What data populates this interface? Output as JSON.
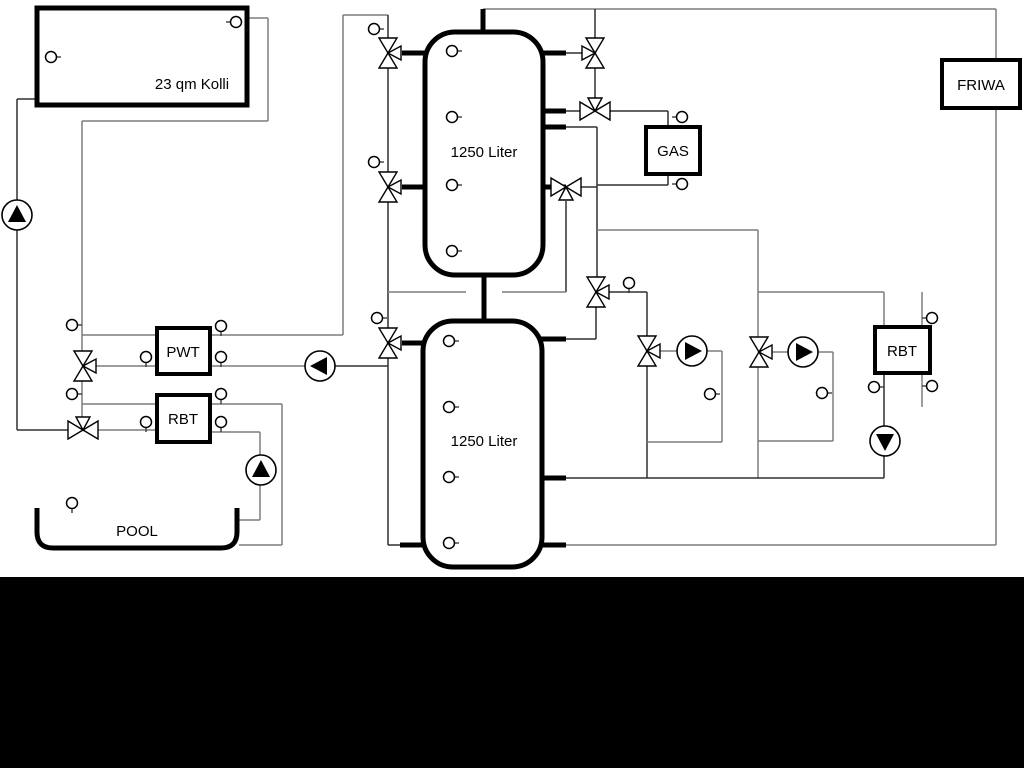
{
  "labels": {
    "collector": "23 qm Kolli",
    "tank1": "1250 Liter",
    "tank2": "1250 Liter",
    "gas": "GAS",
    "friwa": "FRIWA",
    "pwt": "PWT",
    "rbt_left": "RBT",
    "rbt_right": "RBT",
    "pool": "POOL"
  },
  "colors": {
    "dark_pipe": "#303030",
    "gray_pipe": "#7d7d7d",
    "outline": "#000000",
    "fill": "#ffffff",
    "band": "#000000"
  },
  "boxes": [
    {
      "name": "solar-collector-box",
      "key": "collector",
      "x": 37,
      "y": 8,
      "w": 210,
      "h": 97,
      "r": 0,
      "b": 5,
      "lx": 192,
      "ly": 89
    },
    {
      "name": "buffer-tank-1",
      "key": "tank1",
      "x": 425,
      "y": 32,
      "w": 118,
      "h": 243,
      "r": 30,
      "b": 5,
      "lx": 484,
      "ly": 157
    },
    {
      "name": "buffer-tank-2",
      "key": "tank2",
      "x": 423,
      "y": 321,
      "w": 119,
      "h": 246,
      "r": 30,
      "b": 5,
      "lx": 484,
      "ly": 446
    },
    {
      "name": "gas-boiler-box",
      "key": "gas",
      "x": 646,
      "y": 127,
      "w": 54,
      "h": 47,
      "r": 0,
      "b": 4,
      "lx": 673,
      "ly": 156
    },
    {
      "name": "friwa-station-box",
      "key": "friwa",
      "x": 942,
      "y": 60,
      "w": 78,
      "h": 48,
      "r": 0,
      "b": 4,
      "lx": 981,
      "ly": 90
    },
    {
      "name": "pwt-heat-exchanger-box",
      "key": "pwt",
      "x": 157,
      "y": 328,
      "w": 53,
      "h": 46,
      "r": 0,
      "b": 4,
      "lx": 183,
      "ly": 357
    },
    {
      "name": "rbt-left-box",
      "key": "rbt_left",
      "x": 157,
      "y": 395,
      "w": 53,
      "h": 47,
      "r": 0,
      "b": 4,
      "lx": 183,
      "ly": 424
    },
    {
      "name": "rbt-right-box",
      "key": "rbt_right",
      "x": 875,
      "y": 327,
      "w": 55,
      "h": 46,
      "r": 0,
      "b": 4,
      "lx": 902,
      "ly": 356
    }
  ],
  "pool": {
    "path": "M37,508 L37,532 Q37,548 53,548 L221,548 Q237,548 237,532 L237,508",
    "b": 5,
    "lx": 137,
    "ly": 536
  },
  "pipes": [
    [
      37,
      99,
      17,
      99,
      "d"
    ],
    [
      17,
      99,
      17,
      430,
      "d"
    ],
    [
      17,
      430,
      68,
      430,
      "d"
    ],
    [
      247,
      18,
      268,
      18,
      "g"
    ],
    [
      268,
      18,
      268,
      121,
      "g"
    ],
    [
      268,
      121,
      82,
      121,
      "g"
    ],
    [
      82,
      121,
      82,
      351,
      "g"
    ],
    [
      82,
      335,
      157,
      335,
      "g"
    ],
    [
      96,
      366,
      157,
      366,
      "g"
    ],
    [
      82,
      381,
      82,
      417,
      "g"
    ],
    [
      82,
      404,
      157,
      404,
      "g"
    ],
    [
      98,
      430,
      157,
      430,
      "g"
    ],
    [
      210,
      335,
      343,
      335,
      "g"
    ],
    [
      343,
      335,
      343,
      15,
      "g"
    ],
    [
      343,
      15,
      388,
      15,
      "g"
    ],
    [
      210,
      366,
      306,
      366,
      "g"
    ],
    [
      334,
      366,
      388,
      366,
      "d"
    ],
    [
      210,
      404,
      282,
      404,
      "g"
    ],
    [
      282,
      404,
      282,
      545,
      "g"
    ],
    [
      282,
      545,
      239,
      545,
      "g"
    ],
    [
      210,
      432,
      260,
      432,
      "g"
    ],
    [
      260,
      432,
      260,
      456,
      "g"
    ],
    [
      260,
      484,
      260,
      520,
      "g"
    ],
    [
      260,
      520,
      239,
      520,
      "g"
    ],
    [
      388,
      15,
      388,
      38,
      "d"
    ],
    [
      388,
      68,
      388,
      172,
      "d"
    ],
    [
      388,
      202,
      388,
      328,
      "d"
    ],
    [
      388,
      358,
      388,
      545,
      "d"
    ],
    [
      388,
      545,
      404,
      545,
      "d"
    ],
    [
      483,
      9,
      996,
      9,
      "g"
    ],
    [
      996,
      9,
      996,
      60,
      "g"
    ],
    [
      996,
      108,
      996,
      545,
      "g"
    ],
    [
      996,
      545,
      564,
      545,
      "g"
    ],
    [
      566,
      53,
      582,
      53,
      "d"
    ],
    [
      595,
      9,
      595,
      38,
      "d"
    ],
    [
      595,
      68,
      595,
      98,
      "d"
    ],
    [
      566,
      111,
      581,
      111,
      "d"
    ],
    [
      609,
      111,
      668,
      111,
      "d"
    ],
    [
      668,
      111,
      668,
      127,
      "d"
    ],
    [
      566,
      127,
      597,
      127,
      "d"
    ],
    [
      597,
      127,
      597,
      277,
      "d"
    ],
    [
      596,
      307,
      596,
      339,
      "d"
    ],
    [
      596,
      339,
      564,
      339,
      "d"
    ],
    [
      668,
      174,
      668,
      185,
      "d"
    ],
    [
      668,
      185,
      597,
      185,
      "d"
    ],
    [
      581,
      187,
      597,
      187,
      "d"
    ],
    [
      566,
      201,
      566,
      292,
      "d"
    ],
    [
      566,
      292,
      502,
      292,
      "g"
    ],
    [
      466,
      292,
      388,
      292,
      "g"
    ],
    [
      597,
      230,
      758,
      230,
      "g"
    ],
    [
      758,
      230,
      758,
      337,
      "g"
    ],
    [
      758,
      367,
      758,
      478,
      "g"
    ],
    [
      758,
      292,
      884,
      292,
      "g"
    ],
    [
      884,
      292,
      884,
      327,
      "g"
    ],
    [
      884,
      373,
      884,
      426,
      "d"
    ],
    [
      884,
      456,
      884,
      478,
      "d"
    ],
    [
      609,
      292,
      647,
      292,
      "d"
    ],
    [
      647,
      292,
      647,
      336,
      "d"
    ],
    [
      647,
      366,
      647,
      478,
      "d"
    ],
    [
      660,
      351,
      677,
      351,
      "g"
    ],
    [
      707,
      351,
      722,
      351,
      "g"
    ],
    [
      722,
      351,
      722,
      442,
      "g"
    ],
    [
      722,
      442,
      647,
      442,
      "g"
    ],
    [
      772,
      352,
      788,
      352,
      "g"
    ],
    [
      818,
      352,
      833,
      352,
      "g"
    ],
    [
      833,
      352,
      833,
      441,
      "g"
    ],
    [
      833,
      441,
      758,
      441,
      "g"
    ],
    [
      566,
      478,
      884,
      478,
      "d"
    ],
    [
      922,
      292,
      922,
      407,
      "g"
    ]
  ],
  "stubs": [
    [
      483,
      9,
      483,
      34
    ],
    [
      484,
      273,
      484,
      323
    ],
    [
      402,
      53,
      427,
      53
    ],
    [
      402,
      187,
      427,
      187
    ],
    [
      541,
      53,
      566,
      53
    ],
    [
      541,
      111,
      566,
      111
    ],
    [
      541,
      127,
      566,
      127
    ],
    [
      541,
      187,
      566,
      187
    ],
    [
      402,
      343,
      425,
      343
    ],
    [
      400,
      545,
      425,
      545
    ],
    [
      540,
      339,
      566,
      339
    ],
    [
      540,
      478,
      566,
      478
    ],
    [
      540,
      545,
      566,
      545
    ]
  ],
  "valves": [
    [
      388,
      53,
      "v",
      "right"
    ],
    [
      388,
      187,
      "v",
      "right"
    ],
    [
      388,
      343,
      "v",
      "right"
    ],
    [
      595,
      53,
      "v",
      "left"
    ],
    [
      595,
      111,
      "h",
      "top"
    ],
    [
      566,
      187,
      "h",
      "bottom"
    ],
    [
      596,
      292,
      "v",
      "right"
    ],
    [
      647,
      351,
      "v",
      "right"
    ],
    [
      759,
      352,
      "v",
      "right"
    ],
    [
      83,
      366,
      "v",
      "right"
    ],
    [
      83,
      430,
      "h",
      "top"
    ]
  ],
  "pumps": [
    [
      17,
      215,
      "up"
    ],
    [
      320,
      366,
      "left"
    ],
    [
      261,
      470,
      "up"
    ],
    [
      692,
      351,
      "right"
    ],
    [
      803,
      352,
      "right"
    ],
    [
      885,
      441,
      "down"
    ]
  ],
  "sensors": [
    [
      236,
      22,
      "left"
    ],
    [
      51,
      57,
      "right"
    ],
    [
      452,
      51,
      "right"
    ],
    [
      452,
      117,
      "right"
    ],
    [
      452,
      185,
      "right"
    ],
    [
      452,
      251,
      "right"
    ],
    [
      449,
      341,
      "right"
    ],
    [
      449,
      407,
      "right"
    ],
    [
      449,
      477,
      "right"
    ],
    [
      449,
      543,
      "right"
    ],
    [
      72,
      325,
      "right"
    ],
    [
      72,
      394,
      "right"
    ],
    [
      374,
      29,
      "right"
    ],
    [
      374,
      162,
      "right"
    ],
    [
      377,
      318,
      "right"
    ],
    [
      221,
      326,
      "down"
    ],
    [
      146,
      357,
      "down"
    ],
    [
      221,
      357,
      "down"
    ],
    [
      221,
      394,
      "down"
    ],
    [
      146,
      422,
      "down"
    ],
    [
      221,
      422,
      "down"
    ],
    [
      72,
      503,
      "down"
    ],
    [
      629,
      283,
      "down"
    ],
    [
      682,
      117,
      "left"
    ],
    [
      682,
      184,
      "left"
    ],
    [
      710,
      394,
      "right"
    ],
    [
      822,
      393,
      "right"
    ],
    [
      874,
      387,
      "right"
    ],
    [
      932,
      318,
      "left"
    ],
    [
      932,
      386,
      "left"
    ]
  ],
  "band": {
    "x": 0,
    "y": 577,
    "w": 1024,
    "h": 191
  }
}
